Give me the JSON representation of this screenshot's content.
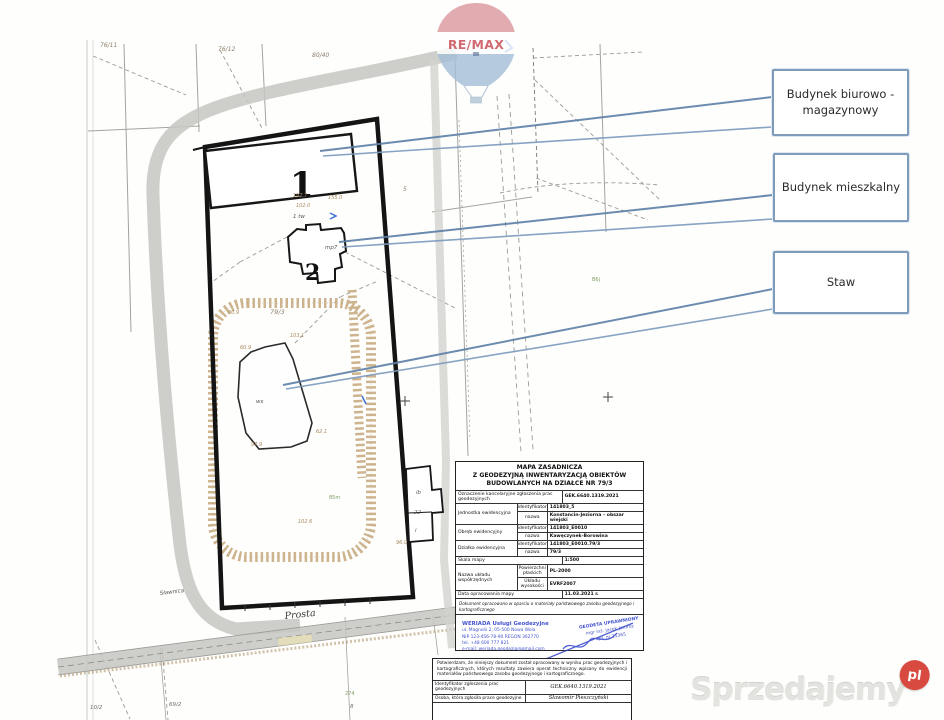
{
  "watermarks": {
    "remax": "RE/MAX",
    "portal": "Sprzedajemy",
    "tld": "pl"
  },
  "callouts": [
    {
      "label": "Budynek biurowo - magazynowy"
    },
    {
      "label": "Budynek mieszkalny"
    },
    {
      "label": "Staw"
    }
  ],
  "map": {
    "labels": {
      "p76a": "76/11",
      "p76b": "76/12",
      "p80": "80/40",
      "p5": "5",
      "p79": "79/3",
      "p10": "10/2",
      "p69": "69/2",
      "p8": "8",
      "b1": "1",
      "b2": "2",
      "mp7": "mp7",
      "tw": "1 tw",
      "ws": "ws",
      "street": "Prosta",
      "street2": "Sławnica",
      "nb1": "ib",
      "nb2": "22",
      "nb3": "i",
      "g1": "B6j",
      "g2": "85m",
      "g3": "274",
      "e1": "197.7",
      "e2": "102.0",
      "e3": "155.0",
      "e4": "103.1",
      "e5": "60.9",
      "e6": "97.9",
      "e7": "62.1",
      "e8": "80.9",
      "e9": "102.6",
      "e10": "96.0"
    }
  },
  "titleblock": {
    "title_line1": "MAPA ZASADNICZA",
    "title_line2": "Z GEODEZYJNĄ INWENTARYZACJĄ OBIEKTÓW",
    "title_line3": "BUDOWLANYCH NA DZIAŁCE NR 79/3",
    "kanc_label": "Oznaczenie kancelaryjne zgłoszenia prac geodezyjnych",
    "kanc_value": "GEK.6640.1319.2021",
    "jednostka_label": "Jednostka ewidencyjna",
    "obreb_label": "Obręb ewidencyjny",
    "dzialka_label": "Działka ewidencyjna",
    "identyfikator_label": "identyfikator",
    "nazwa_label": "nazwa",
    "jednostka_id": "141803_5",
    "jednostka_nazwa": "Konstancin-Jeziorna – obszar wiejski",
    "obreb_id": "141803_E0010",
    "obreb_nazwa": "Kawęczynek-Borowina",
    "dzialka_id": "141803_E0010.79/3",
    "dzialka_nazwa": "79/3",
    "skala_label": "Skala mapy",
    "skala_value": "1:500",
    "uklad_label": "Nazwa układu współrzędnych",
    "plaski_label": "Powierzchni płaskich",
    "plaski_value": "PL-2000",
    "wysokosci_label": "Układu wysokości",
    "wysokosci_value": "EVRF2007",
    "data_label": "Data opracowania mapy",
    "data_value": "11.03.2021 r.",
    "note": "Dokument opracowano w oparciu o materiały państwowego zasobu geodezyjnego i kartograficznego"
  },
  "stamps": {
    "firm_name": "WERIADA Usługi Geodezyjne",
    "firm_line1": "ul. Magnolii 2, 05-500 Nowa Wola",
    "firm_line2": "NIP 123-456-78-90  REGON 362770",
    "firm_line3": "tel. +48 600 777 821",
    "firm_line4": "e-mail: weriada.geodezja@gmail.com",
    "surveyor_title": "GEODETA UPRAWNIONY",
    "surveyor_name": "mgr inż. Jacek Jamróz",
    "surveyor_no": "upr. nr 21365"
  },
  "certificate": {
    "paragraph": "Potwierdzam, że niniejszy dokument został opracowany w wyniku prac geodezyjnych i kartograficznych, których rezultaty zawiera operat techniczny wpisany do ewidencji materiałów państwowego zasobu geodezyjnego i kartograficznego.",
    "id_label": "Identyfikator zgłoszenia prac geodezyjnych",
    "id_value": "GEK.6640.1319.2021",
    "author_label": "Osoba, która zgłosiła prace geodezyjne",
    "author_value": "Sławomir Pieszczyński"
  }
}
